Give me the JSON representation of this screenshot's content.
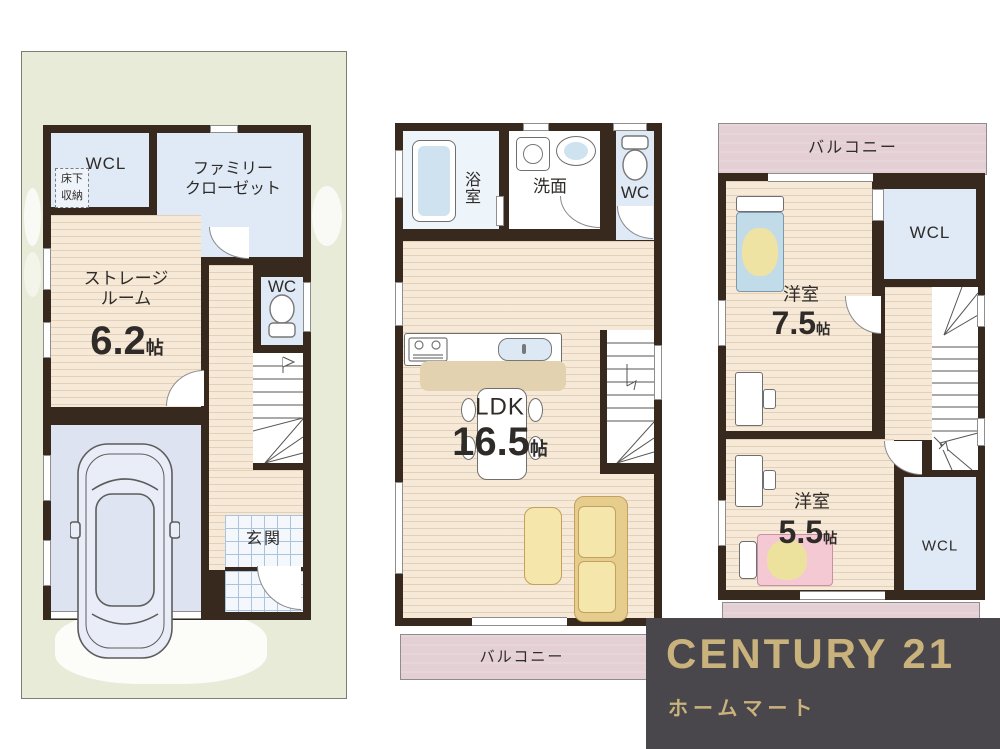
{
  "floor1": {
    "labels": {
      "wcl": "WCL",
      "underfloor_line1": "床下",
      "underfloor_line2": "収納",
      "family_closet_line1": "ファミリー",
      "family_closet_line2": "クローゼット",
      "storage_line1": "ストレージ",
      "storage_line2": "ルーム",
      "storage_size": "6.2",
      "storage_unit": "帖",
      "wc": "WC",
      "entrance": "玄関"
    }
  },
  "floor2": {
    "labels": {
      "bath_char1": "浴",
      "bath_char2": "室",
      "washroom": "洗面",
      "wc": "WC",
      "ldk": "LDK",
      "ldk_size": "16.5",
      "ldk_unit": "帖",
      "balcony": "バルコニー"
    }
  },
  "floor3": {
    "labels": {
      "balcony": "バルコニー",
      "wcl_upper": "WCL",
      "room1_name": "洋室",
      "room1_size": "7.5",
      "room1_unit": "帖",
      "room2_name": "洋室",
      "room2_size": "5.5",
      "room2_unit": "帖",
      "wcl_lower": "WCL"
    }
  },
  "logo": {
    "brand": "CENTURY 21",
    "company": "ホームマート"
  },
  "colors": {
    "wall": "#38291f",
    "site_green": "#e7ebd7",
    "wood_floor": "#f6e9d7",
    "closet_blue": "#dfeaf6",
    "garage_lavender": "#dee3f1",
    "balcony_pink": "#e3cfd4",
    "logo_background": "#49474b",
    "logo_gold": "#c9b27c"
  }
}
